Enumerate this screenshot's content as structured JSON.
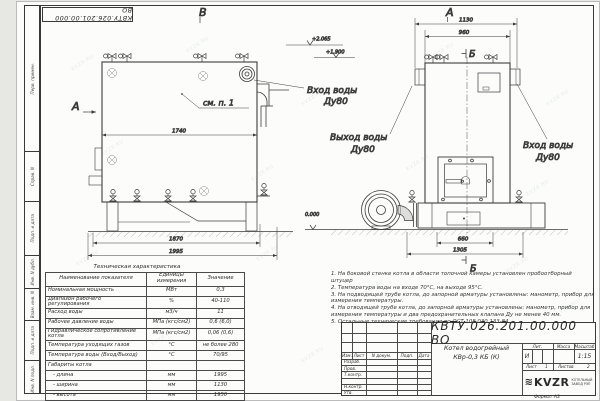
{
  "watermark": "KVZR.RU",
  "stamp": {
    "doc_number_top": "КВТУ.026.201.00.000  ВО"
  },
  "margin_labels": [
    "Перв. примен.",
    "Справ. N",
    "Подп. и дата",
    "Инв. N дубл.",
    "Взам. инв. N",
    "Подп. и дата",
    "Инв. N подл."
  ],
  "views": {
    "left": {
      "label": "В",
      "section_arrow": "А",
      "callout_note": "см. п. 1",
      "dims": {
        "width": "1740",
        "base": "1870",
        "length": "1995"
      }
    },
    "front": {
      "label": "А",
      "section_top": "Б",
      "section_bottom": "Б",
      "dims": {
        "outer": "1130",
        "inner": "960",
        "base": "660",
        "full": "1305"
      }
    }
  },
  "elevations": {
    "top": "+2.065",
    "mid": "+1.900",
    "zero": "0.000"
  },
  "callouts": {
    "inlet_left": {
      "line1": "Вход воды",
      "line2": "Ду80"
    },
    "outlet": {
      "line1": "Выход воды",
      "line2": "Ду80"
    },
    "inlet_right": {
      "line1": "Вход воды",
      "line2": "Ду80"
    }
  },
  "tech_table": {
    "title": "Техническая характеристика",
    "headers": {
      "name": "Наименование показателя",
      "units": "Единицы измерения",
      "value": "Значение"
    },
    "rows": [
      {
        "name": "Номинальная мощность",
        "units": "МВт",
        "value": "0,3"
      },
      {
        "name": "Диапазон рабочего регулирования",
        "units": "%",
        "value": "40-110"
      },
      {
        "name": "Расход воды",
        "units": "м3/ч",
        "value": "11"
      },
      {
        "name": "Рабочее давление воды",
        "units": "МПа (кгс/см2)",
        "value": "0,6 (6,0)"
      },
      {
        "name": "Гидравлическое сопротивление котла",
        "units": "МПа (кгс/см2)",
        "value": "0,06 (0,6)"
      },
      {
        "name": "Температура уходящих газов",
        "units": "°С",
        "value": "не более 280"
      },
      {
        "name": "Температура воды (Вход/Выход)",
        "units": "°С",
        "value": "70/95"
      },
      {
        "name": "Габариты котла",
        "units": "",
        "value": ""
      },
      {
        "name": "   - длина",
        "units": "мм",
        "value": "1995"
      },
      {
        "name": "   - ширина",
        "units": "мм",
        "value": "1130"
      },
      {
        "name": "   - высота",
        "units": "мм",
        "value": "1950"
      }
    ]
  },
  "notes": [
    "1.  На боковой стенке котла в области топочной камеры установлен пробоотборный штуцер",
    "2.  Температура воды на входе 70°С, на выходе 95°С.",
    "3.  На подводящей трубе котла, до запорной арматуры установлены: манометр, прибор для измерения температуры.",
    "4.  На отводящей трубе котла, до запорной арматуры установлены: манометр, прибор для измерения температуры и два предохранительных клапана Ду не менее 40 мм.",
    "5.  Остальные технические требования по ОСТ  108.030.133-84."
  ],
  "title_block": {
    "doc_number": "КВТУ.026.201.00.000  ВО",
    "product_name_line1": "Котел водогрейный",
    "product_name_line2": "КВр-0,3  КБ  (К)",
    "header_row": {
      "izm": "Изм.",
      "list": "Лист",
      "doc": "N докум.",
      "sign": "Подп.",
      "date": "Дата"
    },
    "roles": [
      "Разраб.",
      "Пров.",
      "Т.контр.",
      "",
      "Н.контр.",
      "Утв."
    ],
    "lit_header": "Лит.",
    "mass_header": "Масса",
    "scale_header": "Масштаб",
    "lit_value": "И",
    "scale_value": "1:15",
    "sheet_label": "Лист",
    "sheet_value": "1",
    "sheets_label": "Листов",
    "sheets_value": "2",
    "company": {
      "logo": "KVZR",
      "spring": "≋",
      "line1": "КОТЕЛЬНЫЙ",
      "line2": "ЗАВОД РЭП"
    },
    "format_text": "Формат   А3"
  }
}
